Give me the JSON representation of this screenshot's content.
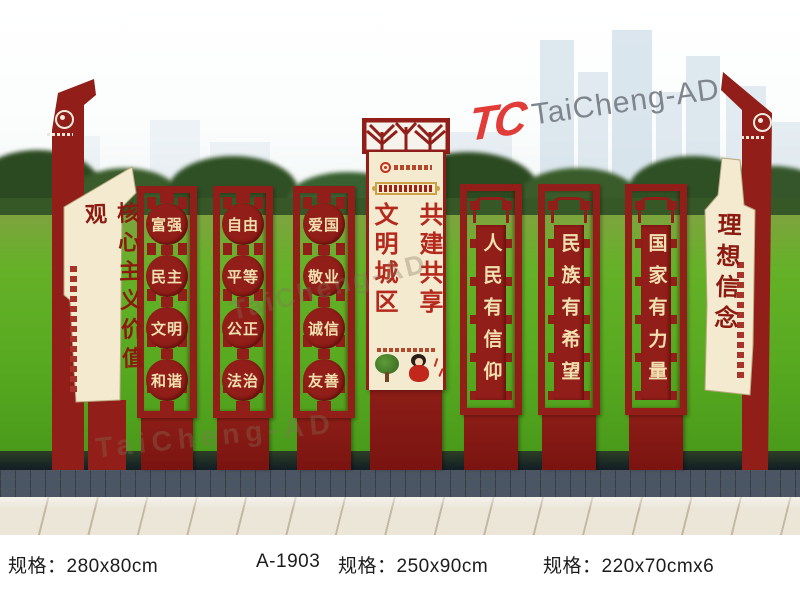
{
  "brand": {
    "monogram": "TC",
    "name": "TaiCheng-AD"
  },
  "left_totem": {
    "title": "核心主义价值观"
  },
  "value_panels": [
    {
      "rows": [
        "富强",
        "民主",
        "文明",
        "和谐"
      ]
    },
    {
      "rows": [
        "自由",
        "平等",
        "公正",
        "法治"
      ]
    },
    {
      "rows": [
        "爱国",
        "敬业",
        "诚信",
        "友善"
      ]
    }
  ],
  "center_panel": {
    "left_column": "文明城区",
    "right_column": "共建共享"
  },
  "slogan_panels": [
    {
      "text": "人民有信仰"
    },
    {
      "text": "民族有希望"
    },
    {
      "text": "国家有力量"
    }
  ],
  "right_totem": {
    "title": "理想信念"
  },
  "specs": [
    {
      "text": "规格：280x80cm"
    },
    {
      "text": "A-1903"
    },
    {
      "text": "规格：250x90cm"
    },
    {
      "text": "规格：220x70cmx6"
    }
  ],
  "colors": {
    "panel_red": "#911e18",
    "cream": "#f4ead0",
    "gold_text": "#f2e0b0",
    "title_red": "#8c1a10",
    "center_text_red": "#b5281c"
  }
}
